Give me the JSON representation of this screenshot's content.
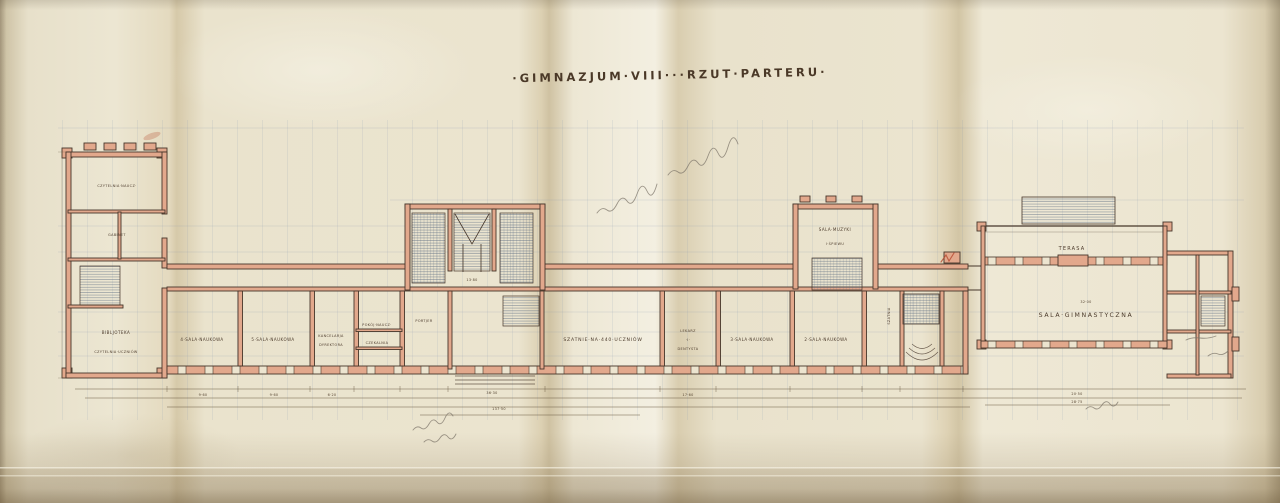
{
  "doc": {
    "title": "·GIMNAZJUM·VIII···RZUT·PARTERU·"
  },
  "rooms": {
    "czytelnia_naucz": "CZYTELNIA·NAUCZ·",
    "gabinet": "GABINET",
    "biblioteka": "BIBLJOTEKA",
    "czytelnia_uczniow": "CZYTELNIA·UCZNIÓW",
    "sala4": "4·SALA·NAUKOWA",
    "sala5": "5·SALA·NAUKOWA",
    "kancelarja": "KANCELARJA",
    "dyrektora": "DYREKTORA",
    "pokoj_naucz": "POKÓJ·NAUCZ·",
    "czekalnia": "CZEKALNIA",
    "portjer": "PORTJER",
    "szatnie": "SZATNIE·NA·440·UCZNIÓW",
    "lekarz": "LEKARZ",
    "lekarz_i": "·I·",
    "dentysta": "DENTYSTA",
    "sala3": "3·SALA·NAUKOWA",
    "sala2": "2·SALA·NAUKOWA",
    "muzyki": "SALA·MUZYKI",
    "spiewu": "I·ŚPIEWU",
    "szatnia": "SZATNIA",
    "terasa": "TERASA",
    "gimnastyczna": "SALA·GIMNASTYCZNA"
  },
  "dims": {
    "d1": "9·60",
    "d2": "9·60",
    "d3": "6·20",
    "d4": "36·30",
    "d5": "137·50",
    "d6": "13·80",
    "d7": "32·00",
    "d8": "17·60",
    "d9": "20·50",
    "d10": "28·75"
  },
  "colors": {
    "ink": "#46362a",
    "wall_fill": "#e2a88c",
    "grid_blue": "#7e93ad",
    "paper": "#ebe4cf",
    "pencil_gray": "#7d766a",
    "red_pencil": "#b5492f"
  }
}
